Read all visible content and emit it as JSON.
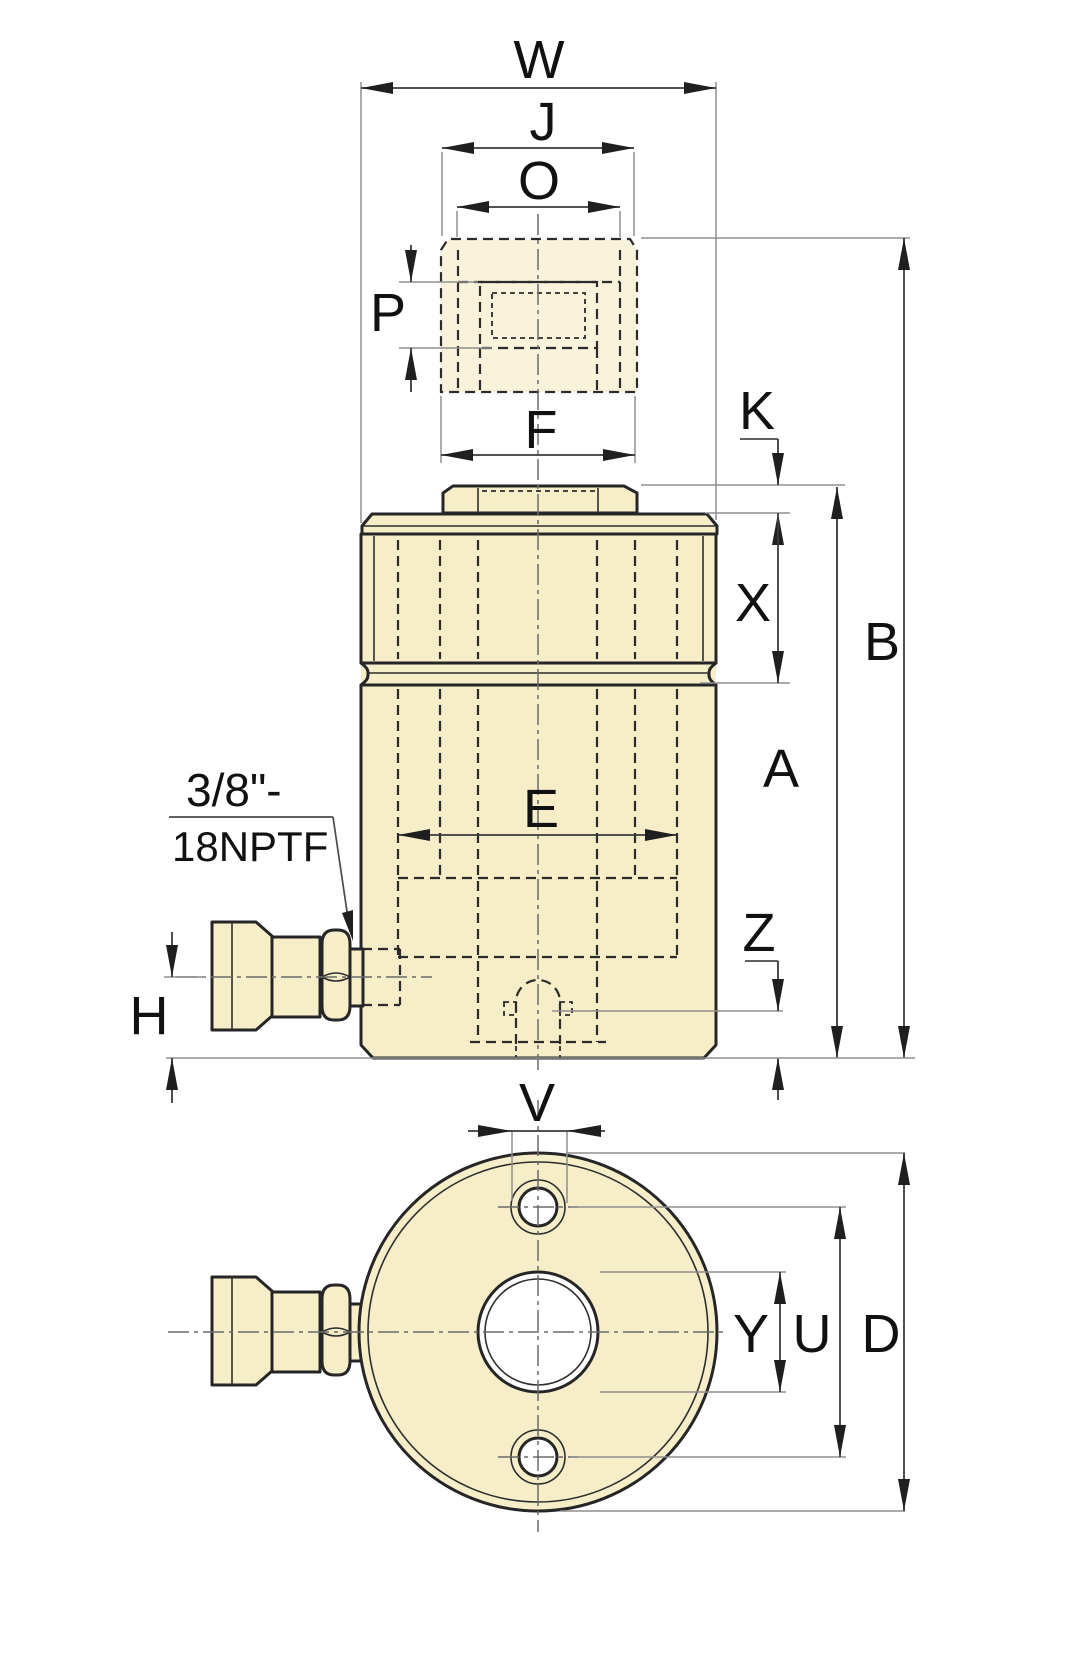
{
  "drawing": {
    "views": [
      "side-view",
      "bottom-view"
    ],
    "dimension_labels": {
      "w": "W",
      "j": "J",
      "o": "O",
      "p": "P",
      "f": "F",
      "k": "K",
      "x": "X",
      "b": "B",
      "a": "A",
      "e": "E",
      "z": "Z",
      "h": "H",
      "v": "V",
      "y": "Y",
      "u": "U",
      "d": "D"
    },
    "port_annotation": {
      "line1": "3/8\"-",
      "line2": "18NPTF"
    },
    "colors": {
      "part_fill": "#f6edc9",
      "plunger_fill": "#f9f3dc",
      "outline": "#262626",
      "hidden_line": "#2b2b2b",
      "dimension_line": "#3a3a3a",
      "extension_line": "#8f8f8f",
      "centerline": "#6a6a6a",
      "label_text": "#111111",
      "background": "#ffffff"
    }
  }
}
